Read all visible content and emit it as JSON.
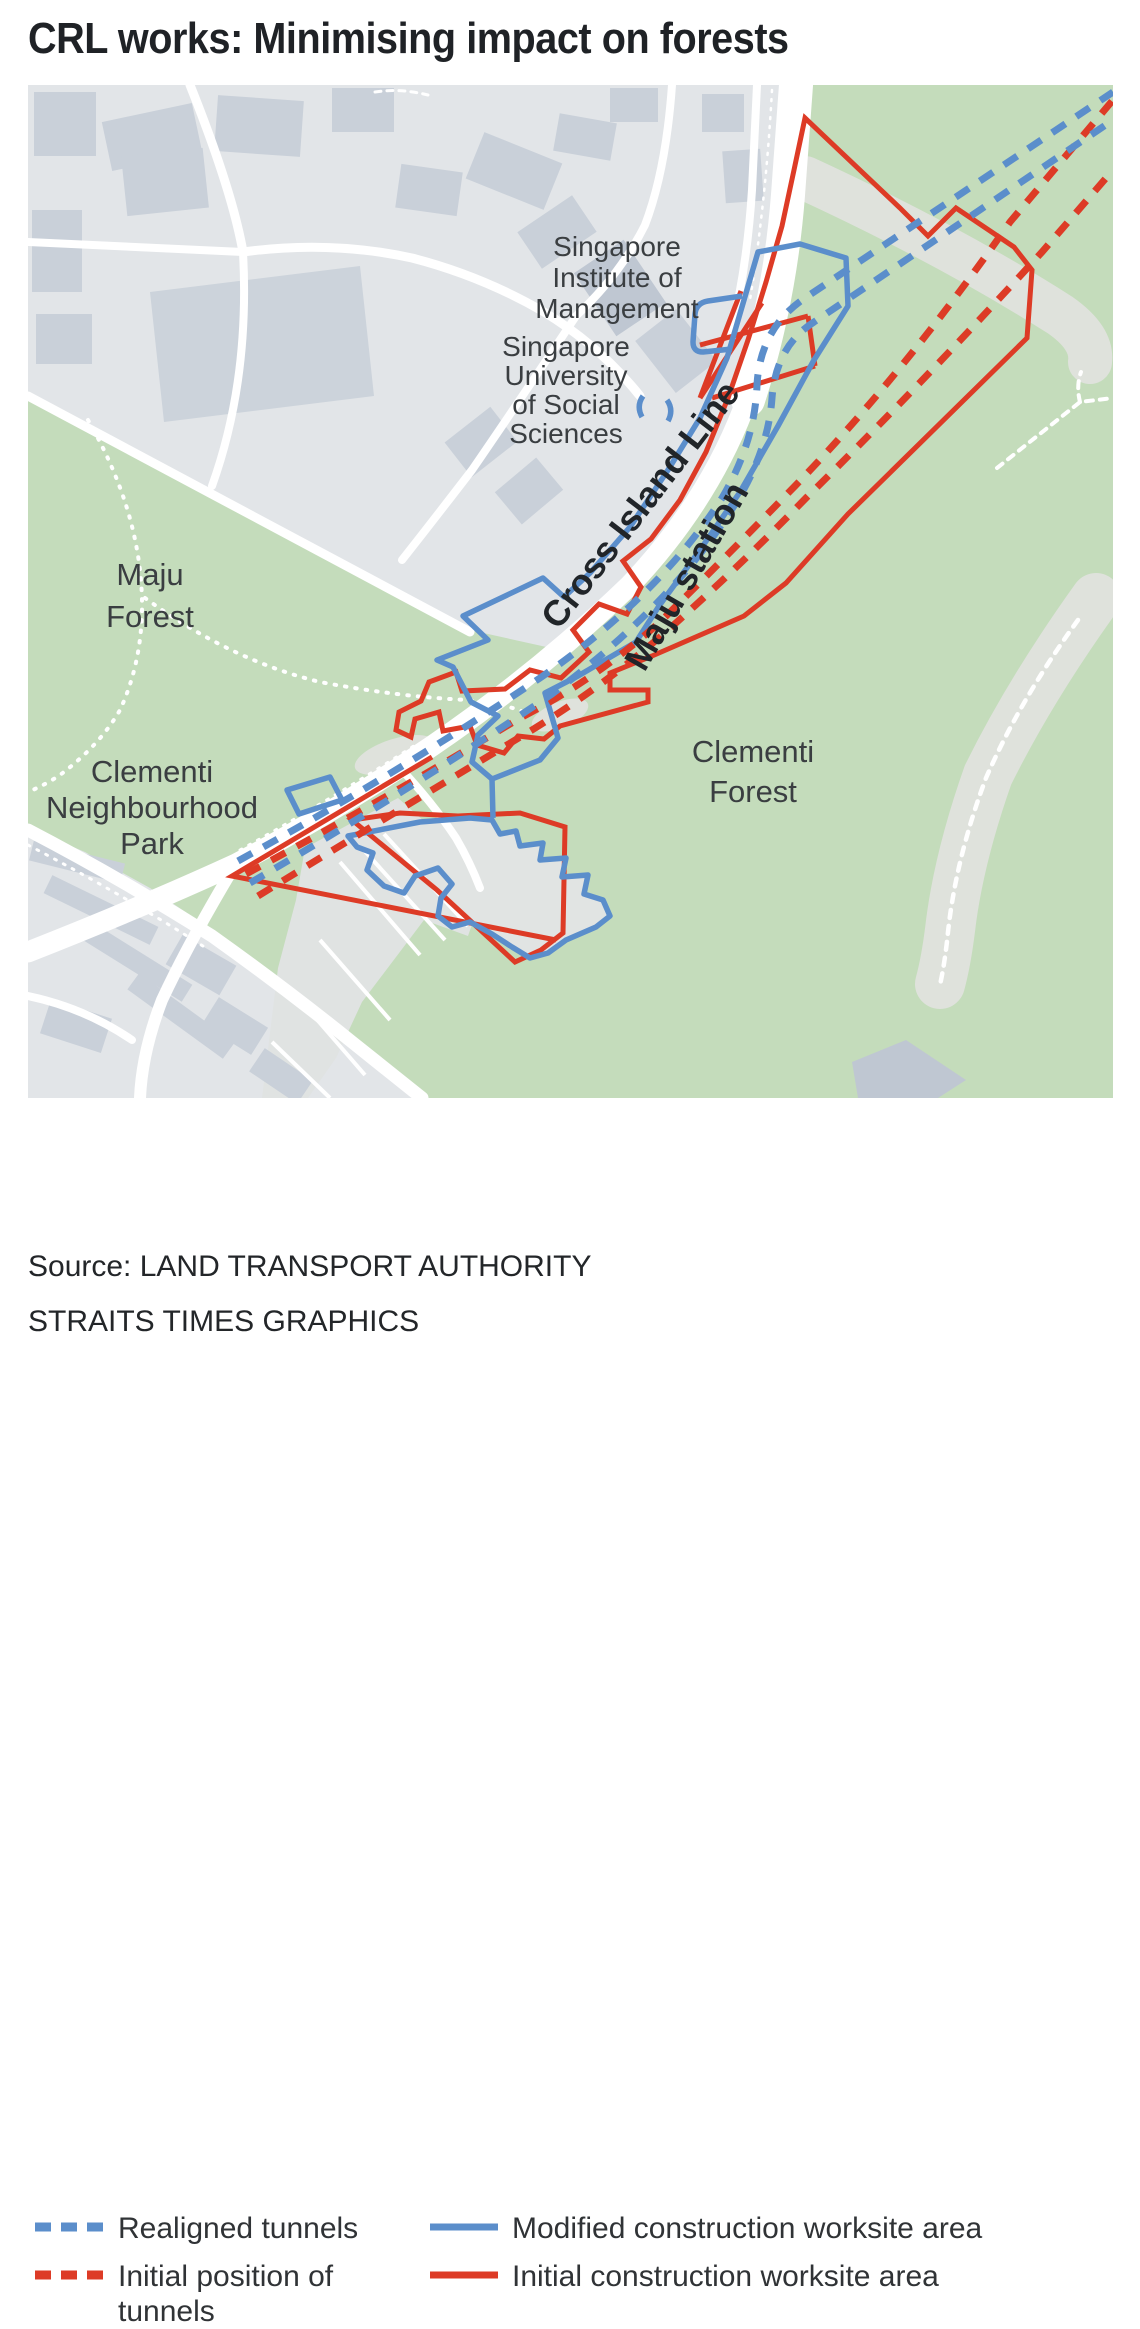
{
  "title": "CRL works: Minimising impact on forests",
  "map": {
    "labels": {
      "sim": [
        "Singapore",
        "Institute of",
        "Management"
      ],
      "suss": [
        "Singapore",
        "University",
        "of Social",
        "Sciences"
      ],
      "maju_forest": [
        "Maju",
        "Forest"
      ],
      "clementi_park": [
        "Clementi",
        "Neighbourhood",
        "Park"
      ],
      "clementi_forest": [
        "Clementi",
        "Forest"
      ],
      "crl_line": "Cross Island Line",
      "maju_station": "Maju station"
    }
  },
  "legend": {
    "realigned_tunnels": "Realigned tunnels",
    "initial_tunnels": "Initial position of tunnels",
    "modified_worksite": "Modified construction worksite area",
    "initial_worksite": "Initial construction worksite area"
  },
  "source": {
    "line1": "Source: LAND TRANSPORT AUTHORITY",
    "line2": "STRAITS TIMES GRAPHICS"
  },
  "colors": {
    "tunnel_blue": "#5b8ecb",
    "tunnel_red": "#dd3b26",
    "forest_green": "#c4dcbb",
    "urban_gray": "#e2e5e8",
    "building_gray": "#c9d0d9",
    "building_dark": "#bfc7d2",
    "cleared_gray": "#dfe2dc",
    "road_white": "#ffffff",
    "label_dark": "#3a3e41",
    "station_label_dark": "#212529"
  }
}
